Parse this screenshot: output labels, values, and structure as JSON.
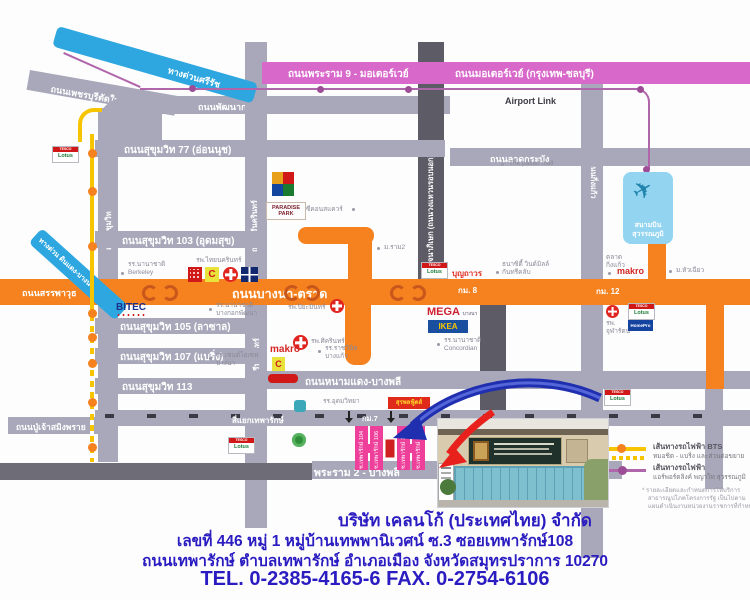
{
  "roads": {
    "rama9": "ถนนพระราม 9 - มอเตอร์เวย์",
    "motorway": "ถนนมอเตอร์เวย์ (กรุงเทพ-ชลบุรี)",
    "srirat": "ทางด่วนศรีรัช",
    "dindaeng_bangna": "ทางด่วน ดินแดง-บางนา",
    "airport_link": "Airport Link",
    "phetchaburi": "ถนนเพชรบุรีตัดใหม่",
    "phatthanakan": "ถนนพัฒนาการ",
    "ladkrabang": "ถนนลาดกระบัง",
    "sukhumvit77": "ถนนสุขุมวิท 77 (อ่อนนุช)",
    "sukhumvit103": "ถนนสุขุมวิท 103 (อุดมสุข)",
    "sukhumvit105": "ถนนสุขุมวิท 105 (ลาซาล)",
    "sukhumvit107": "ถนนสุขุมวิท 107 (แบริ่ง)",
    "sukhumvit113": "ถนนสุขุมวิท 113",
    "sukhumvit": "ถนนสุขุมวิท",
    "srinakarin": "ถนนศรีนครินทร์",
    "kanchanaphisek": "ถนนกาญจนาภิเษก (ถนนวงแหวนรอบนอก)",
    "kingkaew": "ถนนกิ่งแก้ว",
    "bangpli_tamru": "ถนนบางพลี-ตำหรุ",
    "sanphawut": "ถนนสรรพาวุธ",
    "bangna_trat": "ถนนบางนา-ตราด",
    "namdaeng": "ถนนหนามแดง-บางพลี",
    "pujao": "ถนนปู่เจ้าสมิงพราย",
    "rama2": "พระราม 2 - บางพลี",
    "thepharak_junction": "สี่แยกเทพารักษ์",
    "km7": "กม.7",
    "km8": "กม. 8",
    "km12": "กม. 12"
  },
  "landmarks": {
    "berkeley1": "รร.นานาชาติ",
    "berkeley2": "Berkeley",
    "thainakarin": "รพ.ไทยนครินทร์",
    "bitec": "BITEC",
    "patana1": "รร.นานาชาติ",
    "patana2": "บางกอกพัฒนา",
    "paradise": "PARADISE PARK",
    "seacon": "ซีคอนสแควร์",
    "ram2": "ม.ราม2",
    "piyamin": "รพ.ปิยะมินทร์",
    "sikarin": "รพ.ศิครินทร์",
    "makro": "makro",
    "mega": "MEGA",
    "mega_sub": "บางนา",
    "ikea": "IKEA",
    "concordian1": "รร.นานาชาติ",
    "concordian2": "Concordian",
    "ratchawinit1": "รร.ราชวินิต",
    "ratchawinit2": "บางแก้ว",
    "stjoseph1": "รร.เซนต์โยเซฟ",
    "stjoseph2": "บางนา",
    "boonthavorn": "บุญถาวร",
    "thanacity1": "ธนาซิตี้ วินด์มิลล์",
    "thanacity2": "กันทรีคลับ",
    "paseo": "The paseo mall",
    "airport1": "สนามบิน",
    "airport2": "สุวรรณภูมิ",
    "market1": "ตลาด",
    "market2": "กิ่งแก้ว",
    "huachiew": "ม.หัวเฉียว",
    "chularat1": "รพ.",
    "chularat2": "จุฬารัตน์",
    "homepro": "HomePro",
    "tesco": "TESCO",
    "lotus": "Lotus",
    "big_c": "C",
    "udom": "รร.อุดมวิทยา",
    "surapon": "สุรพลฟู้ดส์"
  },
  "sois": {
    "s104": "ซ.เทพารักษ์ 104",
    "s106": "ซ.เทพารักษ์ 106",
    "s108": "ซ.เทพารักษ์ 108",
    "s110": "ซ.เทพารักษ์ 110"
  },
  "legend": {
    "bts_title": "เส้นทางรถไฟฟ้า BTS",
    "bts_sub": "หมอชิต - แบริ่ง และส่วนต่อขยาย",
    "arl_title": "เส้นทางรถไฟฟ้า",
    "arl_sub": "แอร์พอร์ตลิงค์ พญาไท สุวรรณภูมิ",
    "note1": "* รายละเอียดและกำหนดการให้บริการ",
    "note2": "สาธารณูปโภคโครงการรัฐ เป็นไปตาม",
    "note3": "แผนดำเนินงานหน่วยงานราชการที่กำหนด"
  },
  "footer": {
    "company": "บริษัท เคลนโก้ (ประเทศไทย) จำกัด",
    "address1": "เลขที่  446  หมู่ 1 หมู่บ้านเทพพานิเวศน์ ซ.3   ซอยเทพารักษ์108",
    "address2": "ถนนเทพารักษ์  ตำบลเทพารักษ์  อำเภอเมือง  จังหวัดสมุทรปราการ  10270",
    "phone": "TEL. 0-2385-4165-6   FAX. 0-2754-6106"
  },
  "colors": {
    "road_orange": "#f5821f",
    "motorway_pink": "#d968cb",
    "expressway_blue": "#2ea7e0",
    "bts_yellow": "#f7c500",
    "airport_link_purple": "#b066aa",
    "soi_pink": "#ee3f9a",
    "company_text_blue": "#2a1cc0"
  }
}
